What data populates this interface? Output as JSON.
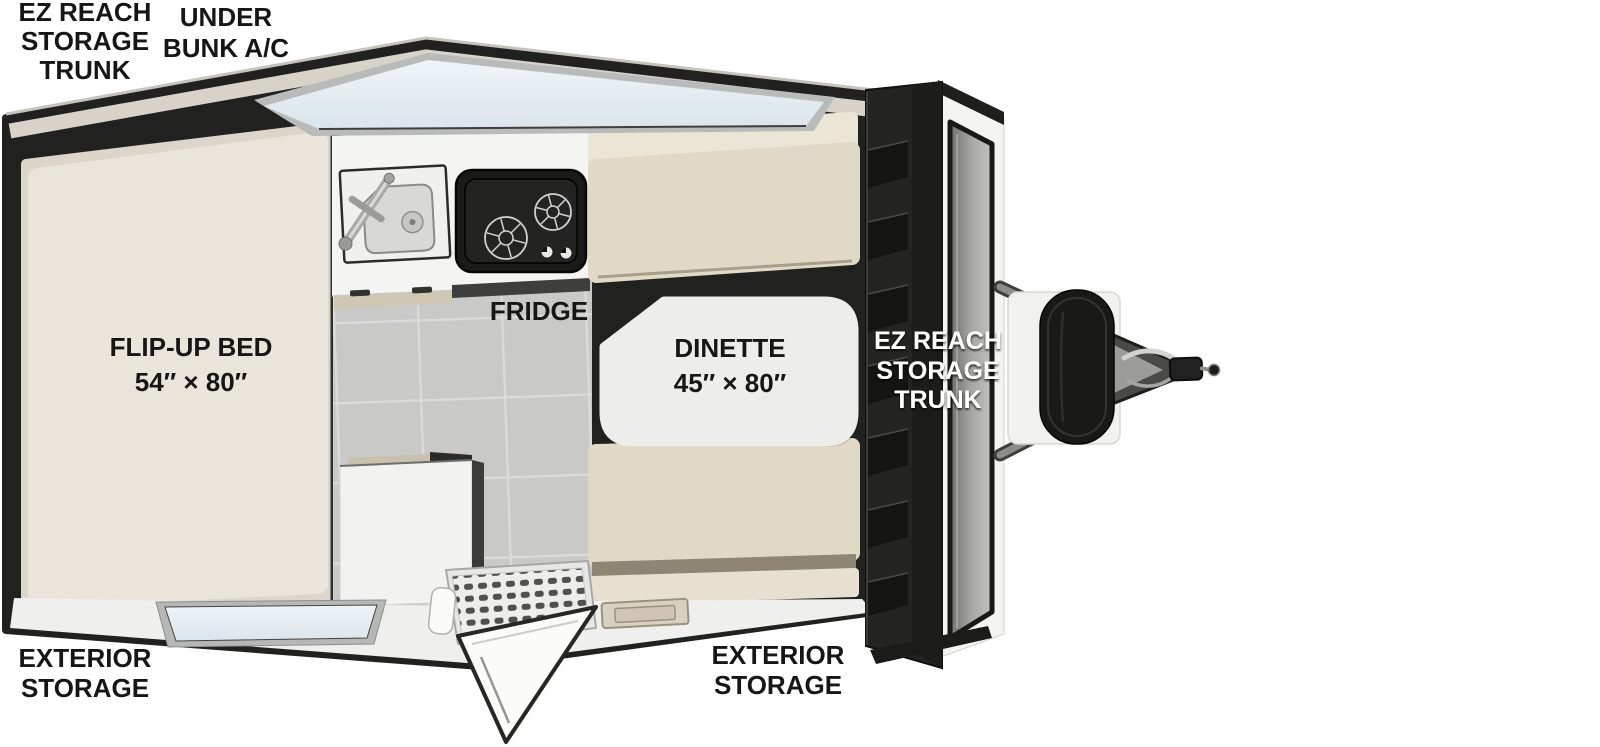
{
  "title": "A-frame camper travel trailer floor plan",
  "labels": {
    "rear_trunk": {
      "line1": "EZ REACH",
      "line2": "STORAGE",
      "line3": "TRUNK"
    },
    "under_bunk_ac": {
      "line1": "UNDER",
      "line2": "BUNK A/C"
    },
    "flip_up_bed": {
      "line1": "FLIP-UP BED",
      "line2": "54″ × 80″"
    },
    "fridge": {
      "line1": "FRIDGE"
    },
    "dinette": {
      "line1": "DINETTE",
      "line2": "45″ × 80″"
    },
    "front_trunk": {
      "line1": "EZ REACH",
      "line2": "STORAGE",
      "line3": "TRUNK"
    },
    "exterior_storage_left": {
      "line1": "EXTERIOR",
      "line2": "STORAGE"
    },
    "exterior_storage_front": {
      "line1": "EXTERIOR",
      "line2": "STORAGE"
    }
  },
  "colors": {
    "background": "#ffffff",
    "body_outline": "#212120",
    "roof_band": "#d7d3c9",
    "bed": "#eae5da",
    "bed_frame": "#dcd6ca",
    "floor_tile": "#c9c9c7",
    "counter": "#f4f4f3",
    "stove": "#1a1a18",
    "cushion": "#e1d9c6",
    "cushion_back": "#ebe5d6",
    "cushion_trim": "#8e8673",
    "table": "#ededec",
    "window_glass": "#e4edf2",
    "trunk": "#242422",
    "propane_tank": "#191917",
    "exterior_skirt": "#efefee",
    "label_text": "#161616",
    "label_text_light": "#ffffff"
  }
}
